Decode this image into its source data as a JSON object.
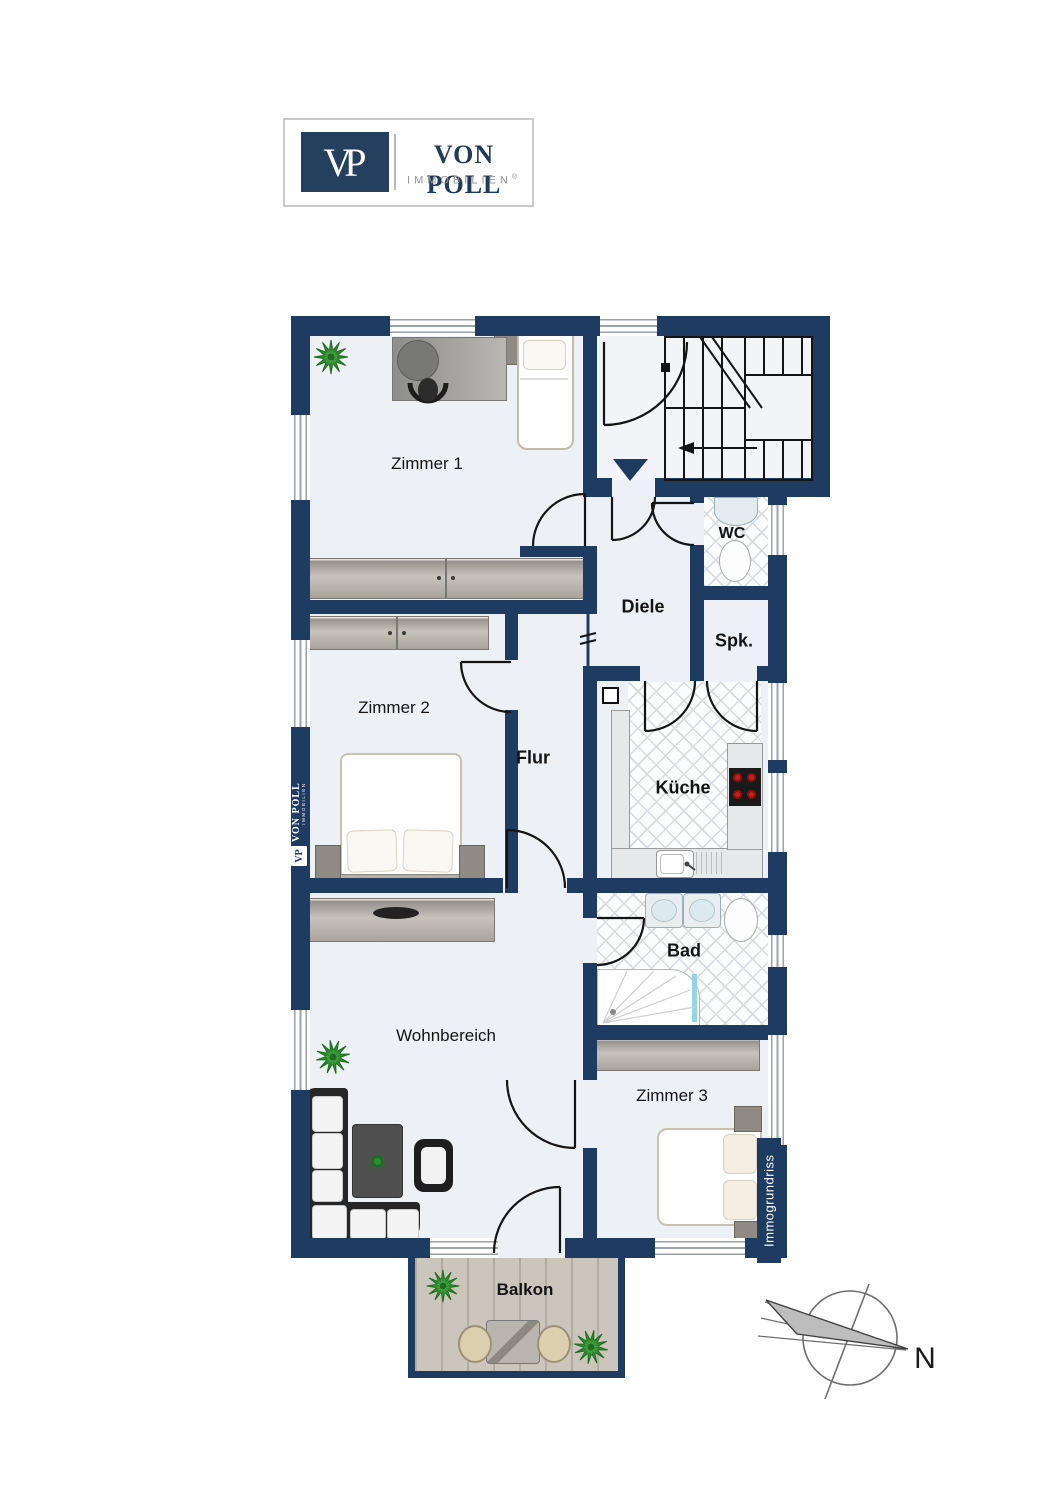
{
  "logo": {
    "monogram": "VP",
    "brand": "VON POLL",
    "subbrand": "IMMOBILIEN",
    "registered": "®"
  },
  "rooms": {
    "zimmer1": {
      "label": "Zimmer 1"
    },
    "zimmer2": {
      "label": "Zimmer 2"
    },
    "zimmer3": {
      "label": "Zimmer 3"
    },
    "wohnbereich": {
      "label": "Wohnbereich"
    },
    "diele": {
      "label": "Diele"
    },
    "flur": {
      "label": "Flur"
    },
    "kueche": {
      "label": "Küche"
    },
    "wc": {
      "label": "WC"
    },
    "spk": {
      "label": "Spk."
    },
    "bad": {
      "label": "Bad"
    },
    "balkon": {
      "label": "Balkon"
    }
  },
  "compass": {
    "north_label": "N"
  },
  "watermarks": {
    "left_monogram": "VP",
    "left_brand": "VON POLL",
    "left_sub": "IMMOBILIEN",
    "right_label": "Immogrundriss"
  },
  "colors": {
    "wall": "#1e3c62",
    "floor": "#edf0f4",
    "stairfloor": "#f2f4f7",
    "tileline": "#d8dadd",
    "line": "#141414",
    "red": "#cf1d1d",
    "cyan": "#8fd9e4",
    "green": "#2e8b2e",
    "greendark": "#1f6b1f",
    "wooda": "#8f8b84",
    "woodb": "#c7c3bc",
    "balcony": "#ccc5bc",
    "balconyline": "#b3aba0",
    "brandnavy": "#24405e",
    "brandtext": "#1f3b5c",
    "brandgray": "#979797",
    "windowline": "#9aa2ac"
  }
}
